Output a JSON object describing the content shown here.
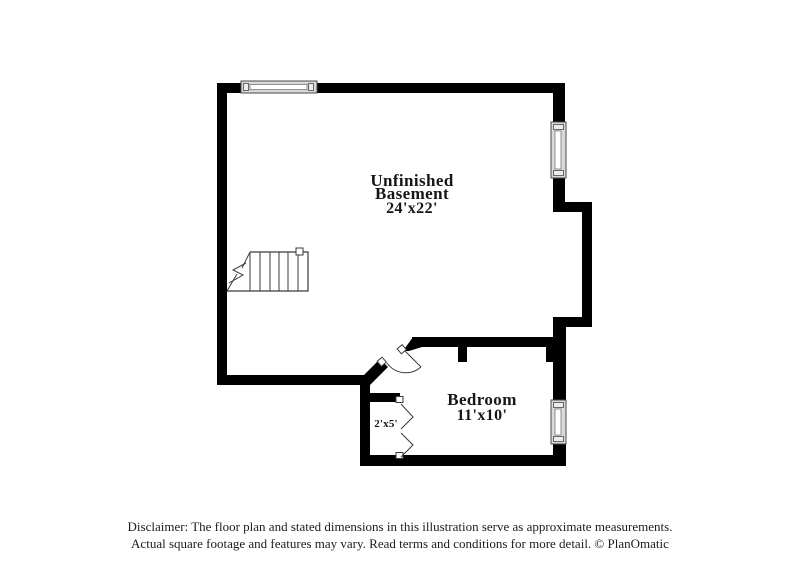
{
  "page": {
    "background_color": "#ffffff",
    "wall_color": "#000000",
    "line_color": "#3a3a3a",
    "window_fill_color": "#d9d9d9",
    "text_color": "#161616"
  },
  "floor_plan": {
    "rooms": {
      "basement": {
        "name_line1": "Unfinished",
        "name_line2": "Basement",
        "dims": "24'x22'"
      },
      "bedroom": {
        "name": "Bedroom",
        "dims": "11'x10'"
      },
      "closet": {
        "dims": "2'x5'"
      }
    },
    "features": {
      "windows_count": 3,
      "stairs": "stairs-icon",
      "swing_door": "door-swing-icon",
      "bifold_doors": "bifold-door-icon"
    }
  },
  "disclaimer": {
    "line1": "Disclaimer: The floor plan and stated dimensions in this illustration serve as approximate measurements.",
    "line2": "Actual square footage and features may vary. Read terms and conditions for more detail. © PlanOmatic"
  }
}
